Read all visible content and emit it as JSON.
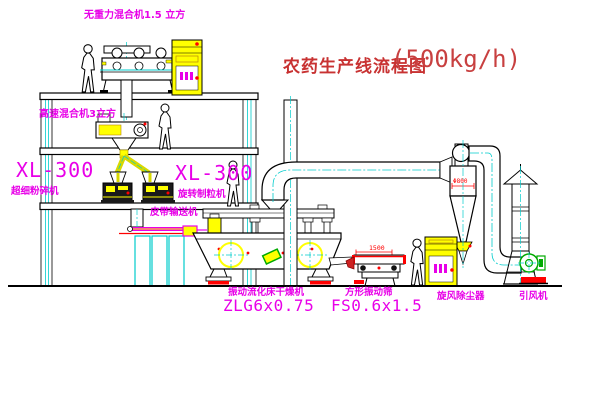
{
  "title": {
    "text": "农药生产线流程图",
    "capacity": "(500kg/h)",
    "color": "#c83232"
  },
  "labels": {
    "gravity_mixer": "无重力混合机1.5 立方",
    "high_speed_mixer": "高速混合机3立方",
    "mill_model": "XL-300",
    "mill_name": "超细粉碎机",
    "granulator_model": "XL-300",
    "granulator_name": "旋转制粒机",
    "belt_conveyor": "皮带输送机",
    "dryer_name": "振动流化床干燥机",
    "dryer_model": "ZLG6x0.75",
    "screen_name": "方形振动筛",
    "screen_model": "FS0.6x1.5",
    "cyclone": "旋风除尘器",
    "fan": "引风机"
  },
  "dimensions": {
    "screen_width": "1500",
    "cyclone_dia": "Φ800"
  },
  "colors": {
    "label_magenta": "#e800e8",
    "line_black": "#000000",
    "centerline_cyan": "#00cccc",
    "equipment_yellow": "#ffff00",
    "dimension_red": "#ff0000",
    "fan_green": "#00aa00",
    "background": "#ffffff"
  }
}
